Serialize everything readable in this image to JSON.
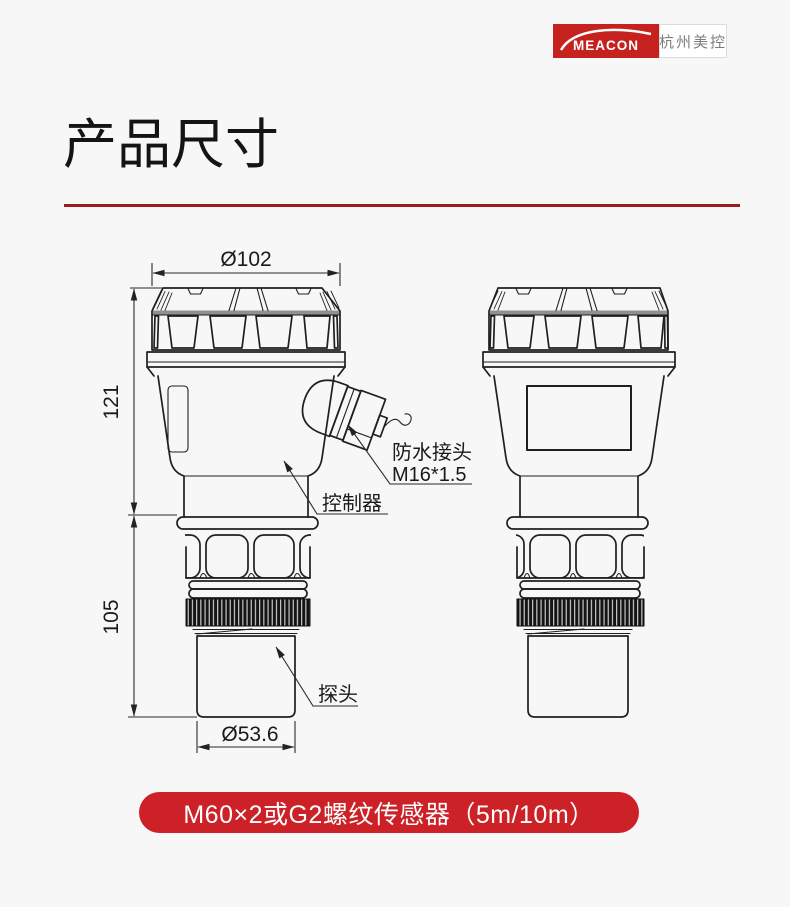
{
  "page": {
    "background": "#f7f7f8"
  },
  "logo": {
    "brand": "MEACON",
    "brand_cn": "杭州美控",
    "brand_red": "#c5221f"
  },
  "header": {
    "title": "产品尺寸",
    "rule_color": "#9e1b20"
  },
  "drawing": {
    "dims": {
      "top_diameter": "Ø102",
      "upper_height": "121",
      "lower_height": "105",
      "probe_diameter": "Ø53.6"
    },
    "labels": {
      "gland_line1": "防水接头",
      "gland_line2": "M16*1.5",
      "controller": "控制器",
      "probe": "探头"
    }
  },
  "banner": {
    "text": "M60×2或G2螺纹传感器（5m/10m）",
    "background": "#cb2127"
  }
}
